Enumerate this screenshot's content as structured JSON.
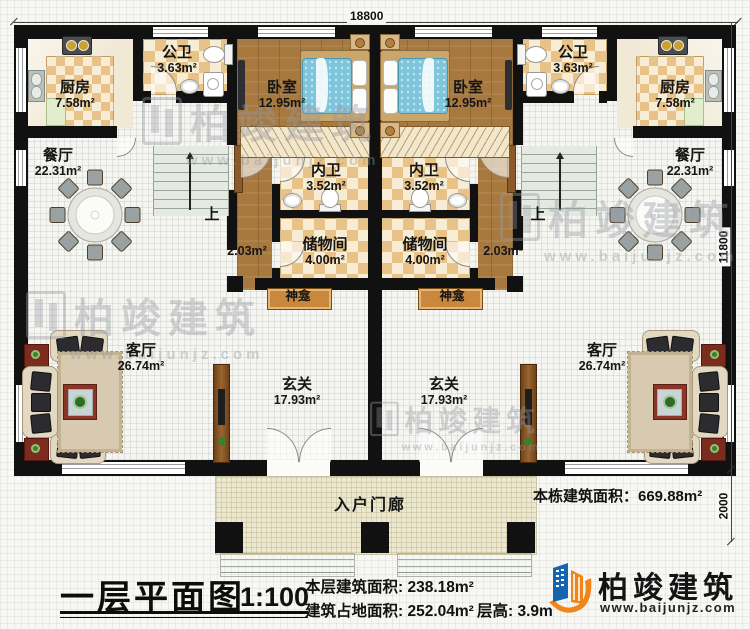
{
  "dimensions": {
    "width_top": "18800",
    "height_main": "11800",
    "height_porch": "2000"
  },
  "rooms": {
    "kitchen": {
      "name": "厨房",
      "area": "7.58m²"
    },
    "public_bath": {
      "name": "公卫",
      "area": "3.63m²"
    },
    "bedroom": {
      "name": "卧室",
      "area": "12.95m²"
    },
    "dining": {
      "name": "餐厅",
      "area": "22.31m²"
    },
    "inner_bath": {
      "name": "内卫",
      "area": "3.52m²"
    },
    "storage": {
      "name": "储物间",
      "area": "4.00m²"
    },
    "shrine": {
      "name": "神龛"
    },
    "landing": {
      "area": "2.03m²"
    },
    "stairs": {
      "up": "上"
    },
    "living": {
      "name": "客厅",
      "area": "26.74m²"
    },
    "foyer": {
      "name": "玄关",
      "area": "17.93m²"
    },
    "porch": {
      "name": "入户门廊"
    }
  },
  "annotation": {
    "building_total_area": "本栋建筑面积：669.88m²"
  },
  "title_block": {
    "title": "一层平面图",
    "scale": "1:100",
    "floor_area": "本层建筑面积: 238.18m²",
    "footprint": "建筑占地面积: 252.04m²",
    "floor_height": "层高: 3.9m"
  },
  "branding": {
    "name": "柏竣建筑",
    "website": "www.baijunjz.com"
  },
  "watermark": {
    "text": "柏竣建筑",
    "website": "www.baijunjz.com"
  },
  "colors": {
    "wall": "#111111",
    "wood_floor": "#a8793f",
    "tile_dark": "#e8c286",
    "tile_light": "#f7ecd4",
    "bed": "#7fc6dc",
    "shrine": "#c8893f",
    "logo_blue": "#1664ad",
    "logo_orange": "#f08519"
  }
}
